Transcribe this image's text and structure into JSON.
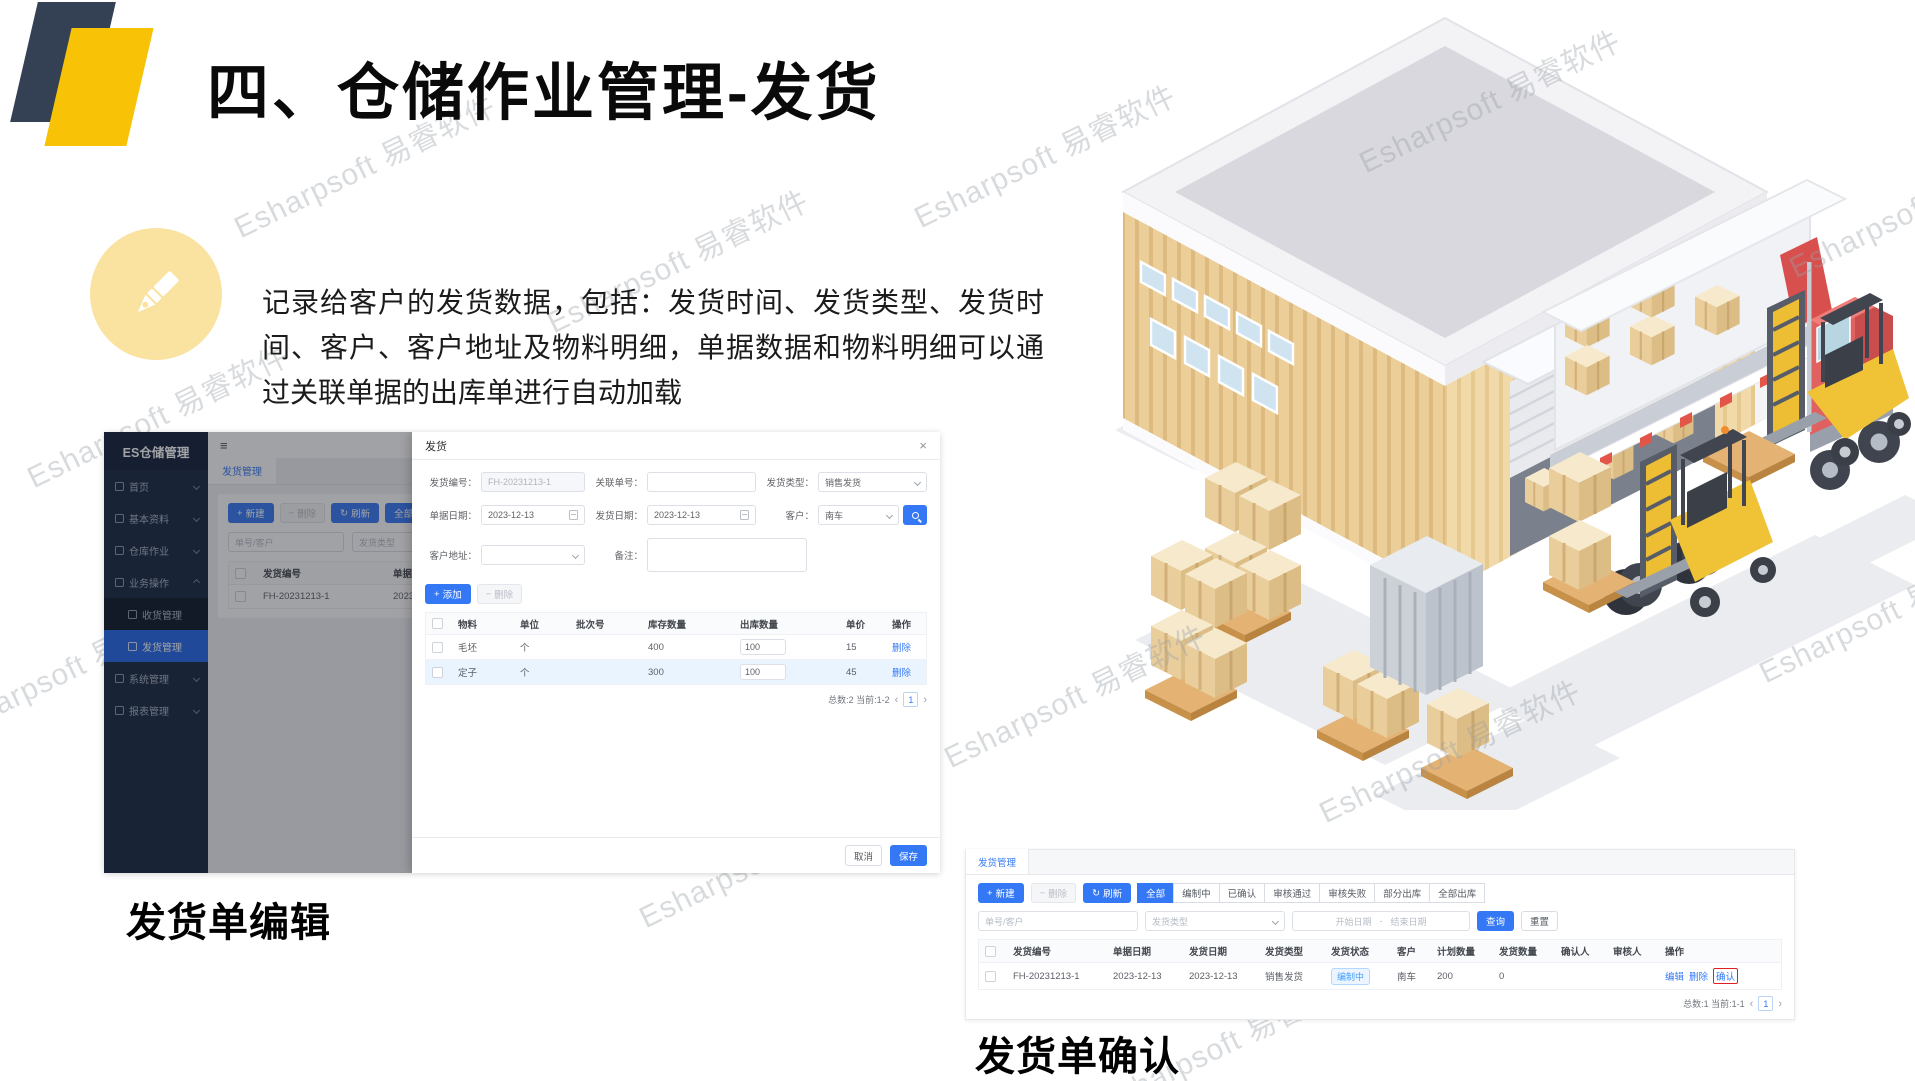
{
  "slide": {
    "title": "四、仓储作业管理-发货",
    "description": "记录给客户的发货数据，包括：发货时间、发货类型、发货时间、客户、客户地址及物料明细，单据数据和物料明细可以通过关联单据的出库单进行自动加载",
    "caption_left": "发货单编辑",
    "caption_right": "发货单确认",
    "watermark": "Esharpsoft 易睿软件",
    "colors": {
      "accent_blue": "#3478f6",
      "brand_yellow": "#f8c307",
      "brand_navy": "#344053",
      "sidebar_navy": "#142541",
      "status_blue": "#409eff",
      "highlight_red": "#e02020"
    }
  },
  "icons": {
    "hamburger": "≡",
    "close": "×",
    "refresh": "↻",
    "plus": "+",
    "minus": "−",
    "prev": "‹",
    "next": "›"
  },
  "edit_screen": {
    "sidebar": {
      "title": "ES仓储管理",
      "items": [
        {
          "label": "首页"
        },
        {
          "label": "基本资料"
        },
        {
          "label": "仓库作业"
        },
        {
          "label": "业务操作"
        },
        {
          "label": "收货管理"
        },
        {
          "label": "发货管理"
        },
        {
          "label": "系统管理"
        },
        {
          "label": "报表管理"
        }
      ]
    },
    "tab": "发货管理",
    "toolbar": {
      "new": "新建",
      "delete": "删除",
      "refresh": "刷新",
      "filter_all": "全部",
      "filter_drafting": "编制中"
    },
    "filters": {
      "order_customer_placeholder": "单号/客户",
      "ship_type_placeholder": "发货类型"
    },
    "table": {
      "headers": [
        "发货编号",
        "单据日期"
      ],
      "row": {
        "ship_no": "FH-20231213-1",
        "doc_date": "2023-12-13"
      }
    },
    "modal": {
      "title": "发货",
      "fields": {
        "ship_no_label": "发货编号：",
        "ship_no_value": "FH-20231213-1",
        "related_no_label": "关联单号：",
        "ship_type_label": "发货类型：",
        "ship_type_value": "销售发货",
        "doc_date_label": "单据日期：",
        "doc_date_value": "2023-12-13",
        "ship_date_label": "发货日期：",
        "ship_date_value": "2023-12-13",
        "customer_label": "客户：",
        "customer_value": "南车",
        "customer_addr_label": "客户地址：",
        "remark_label": "备注："
      },
      "toolbar": {
        "add": "添加",
        "delete": "删除"
      },
      "table": {
        "headers": [
          "物料",
          "单位",
          "批次号",
          "库存数量",
          "出库数量",
          "单价",
          "操作"
        ],
        "rows": [
          {
            "material": "毛坯",
            "unit": "个",
            "batch": "",
            "stock_qty": "400",
            "out_qty": "100",
            "price": "15",
            "action": "删除"
          },
          {
            "material": "定子",
            "unit": "个",
            "batch": "",
            "stock_qty": "300",
            "out_qty": "100",
            "price": "45",
            "action": "删除"
          }
        ],
        "pagination": {
          "summary": "总数:2 当前:1-2",
          "page": "1"
        }
      },
      "footer": {
        "cancel": "取消",
        "save": "保存"
      }
    }
  },
  "confirm_screen": {
    "tab": "发货管理",
    "toolbar": {
      "new": "新建",
      "delete": "删除",
      "refresh": "刷新",
      "status_filters": [
        "全部",
        "编制中",
        "已确认",
        "审核通过",
        "审核失败",
        "部分出库",
        "全部出库"
      ]
    },
    "filters": {
      "order_customer_placeholder": "单号/客户",
      "ship_type_placeholder": "发货类型",
      "start_date_placeholder": "开始日期",
      "range_separator": "-",
      "end_date_placeholder": "结束日期",
      "search": "查询",
      "reset": "重置"
    },
    "table": {
      "headers": [
        "发货编号",
        "单据日期",
        "发货日期",
        "发货类型",
        "发货状态",
        "客户",
        "计划数量",
        "发货数量",
        "确认人",
        "审核人",
        "操作"
      ],
      "row": {
        "ship_no": "FH-20231213-1",
        "doc_date": "2023-12-13",
        "ship_date": "2023-12-13",
        "ship_type": "销售发货",
        "status": "编制中",
        "customer": "南车",
        "plan_qty": "200",
        "ship_qty": "0",
        "confirmer": "",
        "auditor": "",
        "actions": [
          "编辑",
          "删除",
          "确认"
        ]
      },
      "pagination": {
        "summary": "总数:1 当前:1-1",
        "page": "1"
      }
    }
  }
}
